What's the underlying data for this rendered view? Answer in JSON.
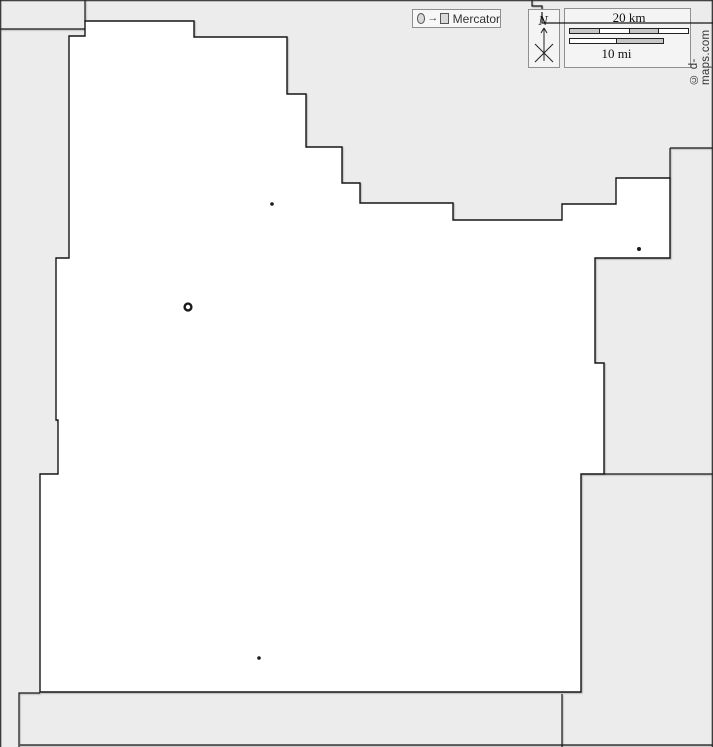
{
  "map": {
    "background_color": "#ececec",
    "region_fill": "#ffffff",
    "line_color": "#161616",
    "county_path": "M85,21 L194,21 L194,37 L287,37 L287,94 L306,94 L306,147 L342,147 L342,183 L360,183 L360,203 L453,203 L453,220 L562,220 L562,204 L616,204 L616,178 L670,178 L670,258 L595,258 L595,363 L604,363 L604,474 L581,474 L581,692 L40,692 L40,474 L58,474 L58,420 L56,420 L56,258 L69,258 L69,36 L85,36 Z",
    "neighbor_paths": [
      "M0,29 L85,29",
      "M85,0 L85,22",
      "M532,0 L532,6 L542,6 L542,12",
      "M670,148 L713,148 M670,148 L670,179",
      "M604,474 L713,474",
      "M40,693 L19,693 L19,747",
      "M20,745 L713,745",
      "M562,694 L562,747"
    ],
    "overlay_line_path": "M542,12 L542,23 L713,23",
    "frame_path": "M0,0.7 L713,0.7 M0.7,0 L0.7,747 M712.3,0 L712.3,747"
  },
  "cities": [
    {
      "label": "",
      "type": "dot",
      "cx": 272,
      "cy": 204,
      "r": 1.8
    },
    {
      "label": "",
      "type": "ring",
      "cx": 188,
      "cy": 307,
      "r": 3.4
    },
    {
      "label": "",
      "type": "dot",
      "cx": 639,
      "cy": 249,
      "r": 2.0
    },
    {
      "label": "",
      "type": "dot",
      "cx": 259,
      "cy": 658,
      "r": 1.8
    }
  ],
  "projection_legend": {
    "label": "Mercator",
    "arrow_glyph": "→",
    "circle_icon": "circle-symbol",
    "square_icon": "square-symbol"
  },
  "compass": {
    "north_label": "N"
  },
  "scale": {
    "km_label": "20 km",
    "mi_label": "10 mi",
    "bar_gray": "#c7c7c7",
    "bar_white": "#ffffff"
  },
  "copyright": {
    "text": "© d-maps.com"
  }
}
